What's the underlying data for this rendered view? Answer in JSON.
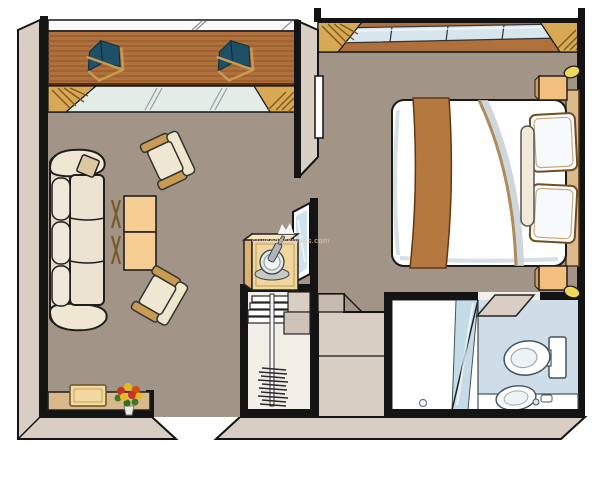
{
  "watermark": {
    "text": "cruisedeckplans.com",
    "logo": "crown-icon"
  },
  "palette": {
    "carpet": "#a39488",
    "wall_band": "#d8cec4",
    "wall_band_shade": "#c7bbb0",
    "wall_outline": "#141414",
    "deck_wood": "#b0703c",
    "deck_stripe": "#8a5526",
    "drape_gold": "#d8a855",
    "door_glass": "#e3ece6",
    "window_glass": "#d7e5ee",
    "deckchair_fabric": "#1d4f66",
    "wood_frame": "#c89b52",
    "upholstery": "#efe7d2",
    "table_wood": "#f6cd92",
    "desk_wood": "#d9b98c",
    "cabinet_wood": "#f2d6a0",
    "bed_linen": "#ffffff",
    "bed_runner": "#b5793f",
    "headboard": "#dcb988",
    "nightstand": "#f2bf7e",
    "lamp": "#f0d75e",
    "bathroom_floor": "#cfdde8",
    "shower_glass": "#c5dce8",
    "closet_interior": "#f2efe9",
    "flower_red": "#d03020",
    "flower_yellow": "#e8b820",
    "leaf_green": "#3a7a28"
  },
  "rooms": [
    "balcony",
    "living-room",
    "bedroom",
    "closet",
    "bathroom"
  ],
  "furniture": [
    "deck-chairs",
    "sofa",
    "armchairs",
    "nesting-tables",
    "console-desk",
    "flower-bouquet",
    "minibar-cabinet",
    "ice-bucket",
    "champagne-bottle",
    "mirror",
    "closet-shelves",
    "hanging-rail-with-hangers",
    "bed",
    "pillows",
    "bolster",
    "nightstands",
    "lamps",
    "shower",
    "glass-partition",
    "toilet",
    "sink"
  ]
}
